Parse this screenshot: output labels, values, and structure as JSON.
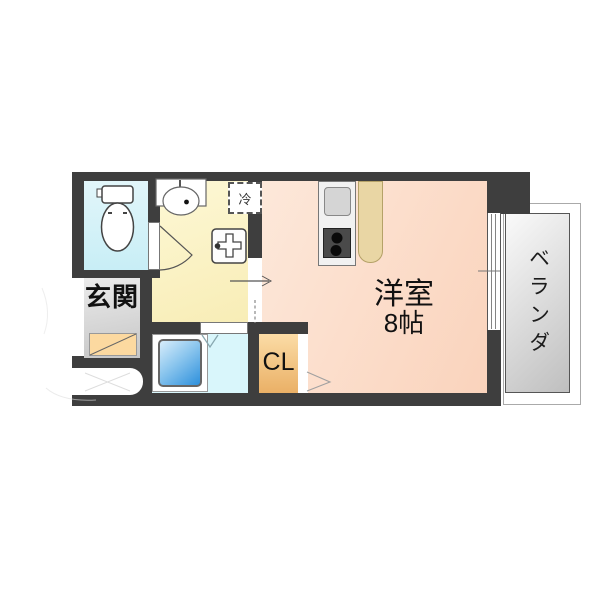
{
  "labels": {
    "entrance": "玄関",
    "refrigerator": "冷",
    "main_room_name": "洋室",
    "main_room_size": "8帖",
    "closet": "CL",
    "veranda": "ベランダ"
  },
  "colors": {
    "wall": "#3e3e3e",
    "main_room_light": "#fde8da",
    "main_room_dark": "#fad3bc",
    "washroom_light": "#fdf8d6",
    "washroom_dark": "#f8edb6",
    "toilet_light": "#e2f6fa",
    "toilet_dark": "#c8eef6",
    "bathroom_floor": "#d9f6fb",
    "bathtub_light": "#d8edfb",
    "bathtub_dark": "#2e90dc",
    "closet_light": "#fbdca6",
    "closet_dark": "#eab066",
    "entrance_light": "#ebebeb",
    "entrance_dark": "#c6c6c6",
    "entrance_step": "#fcd9a0",
    "counter": "#e9d6a4",
    "veranda_light": "#fafafa",
    "veranda_dark": "#bfbfbf",
    "kitchen_unit": "#f1f1f1",
    "stove": "#4a4a4a",
    "line": "#555555"
  }
}
